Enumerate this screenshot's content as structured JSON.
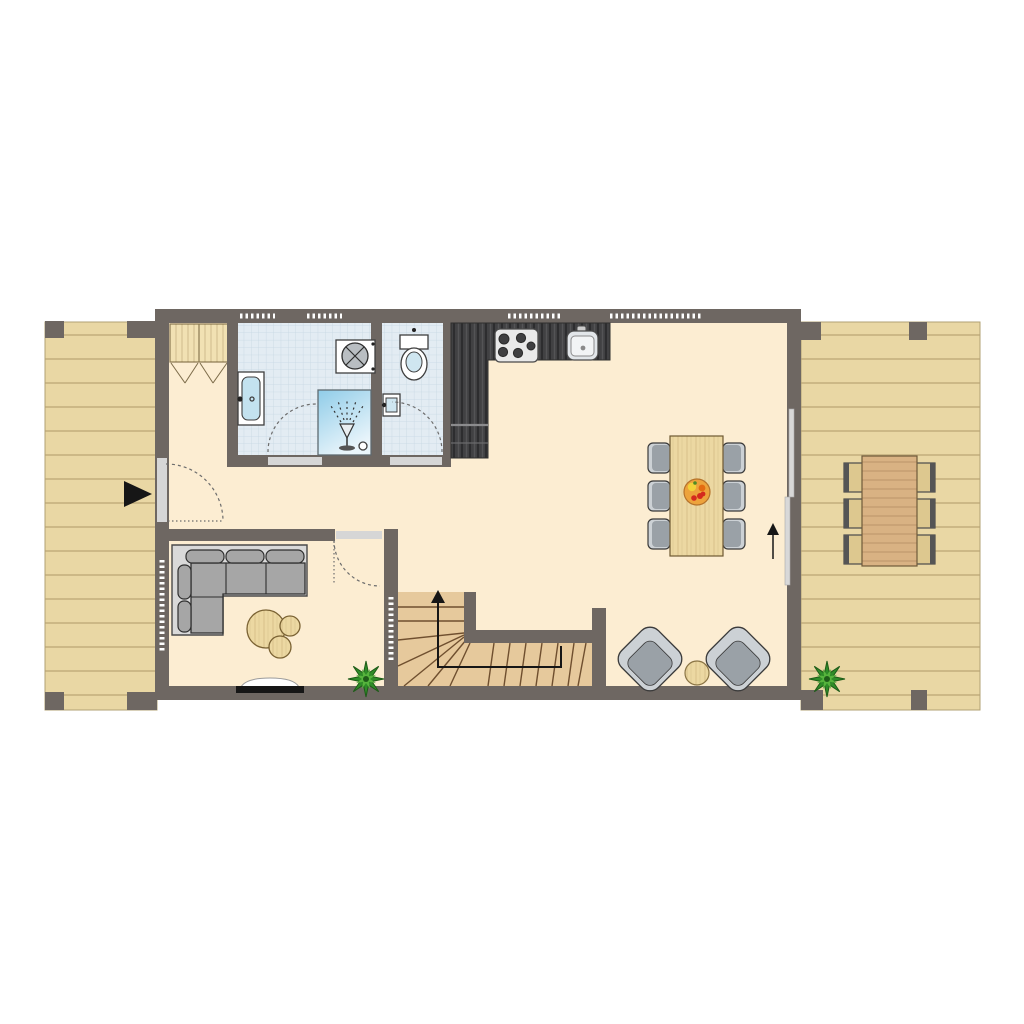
{
  "meta": {
    "type": "floor-plan",
    "view": "top-down architectural plan",
    "visible_text": []
  },
  "colors": {
    "bg": "#ffffff",
    "wall": "#6e6762",
    "floor": "#fcedd2",
    "deck": "#e9d7a4",
    "plankline": "#c3ae7d",
    "deckedge": "#b1a173",
    "tile": "#e3ecf3",
    "tileline": "#c7d7e4",
    "shower1": "#8fcce8",
    "shower2": "#eaf5fb",
    "darkwood": "#414143",
    "chairlight": "#ccd1d5",
    "chairdark": "#9aa1a7",
    "sofaplatform": "#d9d9d9",
    "sofabody": "#a6a6a6",
    "tablewood": "#ecd8a2",
    "stairs": "#e6c99c",
    "stairline": "#6f4f2f",
    "outtable": "#d9b283",
    "outchair": "#ddc88f",
    "threshold": "#d6d6d6",
    "windowmark": "#ffffff",
    "wardrobe": "#f1e1b3",
    "fixture": "#ffffff",
    "outline": "#3f3f3f",
    "plantgreen": "#2f8c28",
    "plantlight": "#57b43d",
    "plantdark": "#1e5c18",
    "fruitbowl": "#eda33c",
    "fruitred": "#d42a1e",
    "ink": "#161616"
  },
  "areas": {
    "terrace_left": {
      "items": [
        {
          "name": "entry-arrow"
        },
        {
          "name": "deck-posts",
          "count": 4
        }
      ]
    },
    "hallway": {
      "items": [
        {
          "name": "wardrobe",
          "doors": 2
        },
        {
          "name": "entry-door"
        }
      ]
    },
    "bathroom": {
      "floor_finish": "blue-tiles",
      "items": [
        {
          "name": "washbasin"
        },
        {
          "name": "washing-machine"
        },
        {
          "name": "shower"
        },
        {
          "name": "door"
        }
      ]
    },
    "wc": {
      "floor_finish": "blue-tiles",
      "items": [
        {
          "name": "toilet"
        },
        {
          "name": "hand-basin"
        },
        {
          "name": "door"
        }
      ]
    },
    "kitchen": {
      "items": [
        {
          "name": "l-shaped-counter"
        },
        {
          "name": "cooktop",
          "burners": 5
        },
        {
          "name": "sink"
        },
        {
          "name": "tall-cabinet"
        }
      ]
    },
    "living_room": {
      "items": [
        {
          "name": "corner-sofa"
        },
        {
          "name": "coffee-table-set",
          "tables": 3
        },
        {
          "name": "tv-lowboard"
        },
        {
          "name": "potted-plant"
        },
        {
          "name": "door"
        }
      ]
    },
    "dining_area": {
      "items": [
        {
          "name": "dining-table"
        },
        {
          "name": "dining-chairs",
          "count": 6
        },
        {
          "name": "fruit-bowl"
        },
        {
          "name": "walk-direction-arrow"
        }
      ]
    },
    "lounge_corner": {
      "items": [
        {
          "name": "lounge-chairs",
          "count": 2
        },
        {
          "name": "side-table"
        }
      ]
    },
    "stairs": {
      "items": [
        {
          "name": "u-shaped-staircase"
        },
        {
          "name": "up-direction-arrow"
        }
      ]
    },
    "terrace_right": {
      "items": [
        {
          "name": "outdoor-dining-table"
        },
        {
          "name": "outdoor-chairs",
          "count": 6
        },
        {
          "name": "potted-plant"
        },
        {
          "name": "sliding-door"
        },
        {
          "name": "deck-posts",
          "count": 4
        }
      ]
    }
  },
  "windows": {
    "top_wall_groups": 4,
    "left_wall_groups": 1,
    "stair_wall_groups": 1
  }
}
